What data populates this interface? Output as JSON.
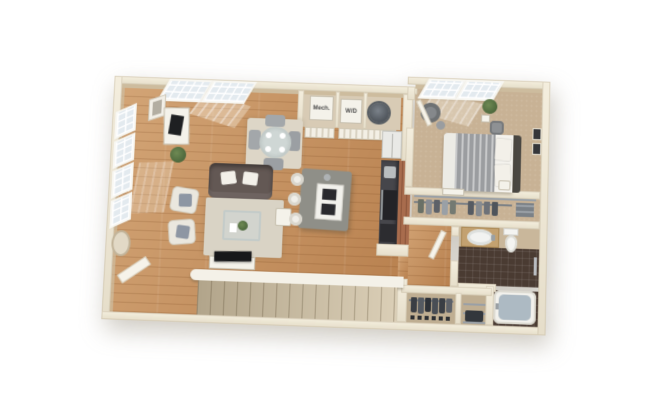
{
  "floorplan": {
    "labels": {
      "mechanical_closet": "Mech.",
      "washer_dryer": "W/D"
    },
    "colors": {
      "background": "#ffffff",
      "exterior_wall": "#ece5d4",
      "interior_wall_face": "#cdbc9e",
      "wood_floor": "#c28a57",
      "carpet": "#c8b295",
      "bathroom_tile": "#4a3b32",
      "kitchen_accent_wall": "#a86c4d",
      "island": "#8f8f88",
      "counter": "#46464b",
      "sofa": "#635854",
      "stair_treads": "#c9bda5",
      "tub_water": "#adbac3",
      "window_glass": "#e3eaef"
    }
  }
}
